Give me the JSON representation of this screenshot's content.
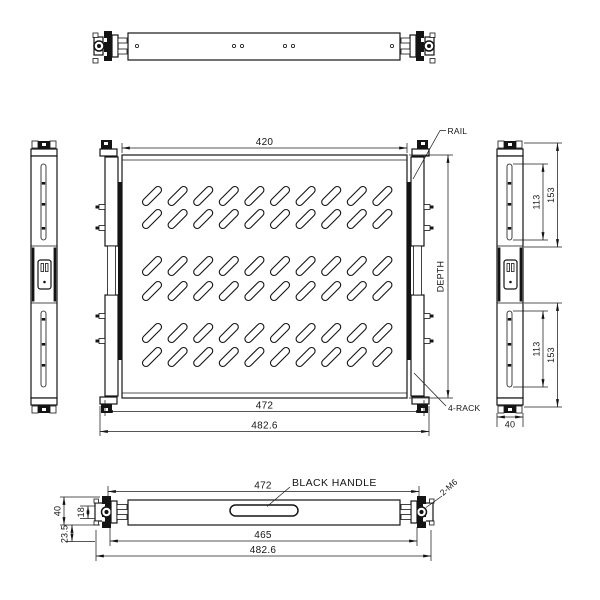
{
  "colors": {
    "line": "#141414",
    "background": "#ffffff"
  },
  "views": {
    "main": {
      "dims": {
        "top_width": "420",
        "rail_width": "472",
        "overall_width": "482.6"
      },
      "labels": {
        "depth": "DEPTH",
        "rail": "RAIL",
        "rack": "4-RACK"
      }
    },
    "side_right": {
      "dims": {
        "upper_slot": "113",
        "upper_section": "153",
        "lower_slot": "113",
        "lower_section": "153",
        "width": "40"
      }
    },
    "front": {
      "labels": {
        "handle": "BLACK HANDLE",
        "screws": "2-M6"
      },
      "dims": {
        "rail_width": "472",
        "handle_width": "465",
        "overall_width": "482.6",
        "height": "40",
        "handle_offset": "18",
        "ear_depth": "23.5"
      }
    }
  }
}
